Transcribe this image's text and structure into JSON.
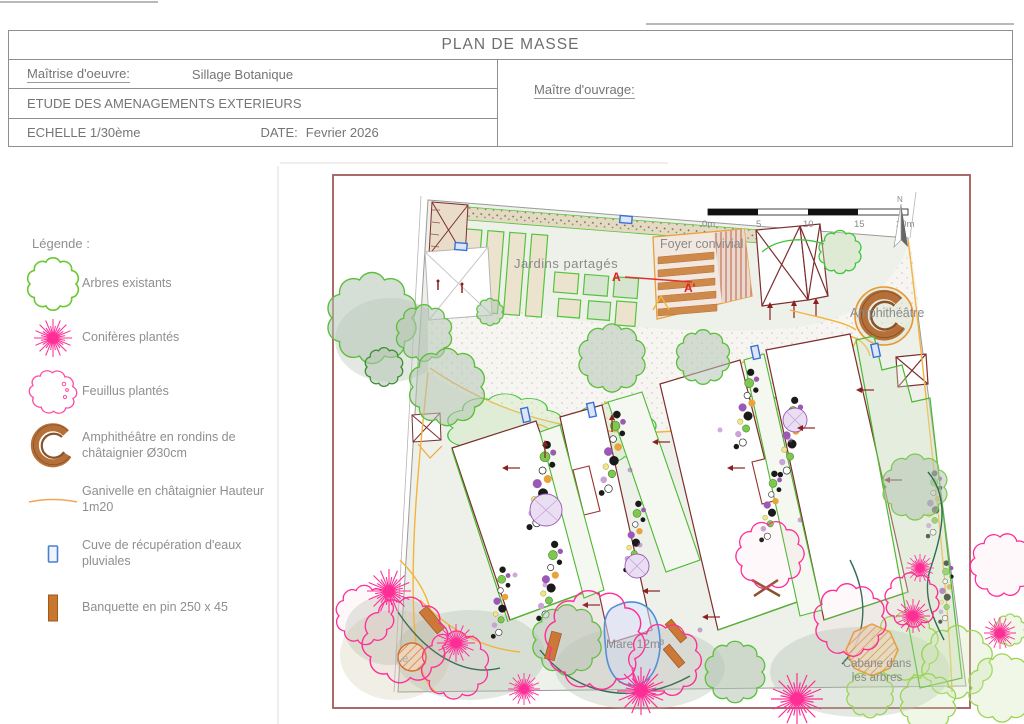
{
  "title_block": {
    "title": "PLAN DE MASSE",
    "moe_label": "Maîtrise d'oeuvre:",
    "moe_value": "Sillage Botanique",
    "study_title": "ETUDE DES AMENAGEMENTS EXTERIEURS",
    "scale": "ECHELLE 1/30ème",
    "date_label": "DATE:",
    "date_value": "Fevrier 2026",
    "moa_label": "Maître d'ouvrage:"
  },
  "legend": {
    "heading": "Légende :",
    "items": [
      {
        "symbol": "existing-tree",
        "label": "Arbres existants"
      },
      {
        "symbol": "planted-conifer",
        "label": "Conifères plantés"
      },
      {
        "symbol": "planted-deciduous",
        "label": "Feuillus plantés"
      },
      {
        "symbol": "amphitheater",
        "label": "Amphithéâtre en rondins de châtaignier Ø30cm"
      },
      {
        "symbol": "ganivelle-fence",
        "label": "Ganivelle en châtaignier Hauteur 1m20"
      },
      {
        "symbol": "rainwater-tank",
        "label": "Cuve de récupération d'eaux pluviales"
      },
      {
        "symbol": "pine-bench",
        "label": "Banquette en pin 250 x 45"
      }
    ]
  },
  "plan": {
    "labels": {
      "jardins_partages": "Jardins partagés",
      "foyer_convivial": "Foyer convivial",
      "amphitheatre": "Amphithéâtre",
      "mare": "Mare 12m³",
      "cabane_line1": "Cabane dans",
      "cabane_line2": "les arbres",
      "bottom_left": "Le",
      "section_start": "A",
      "section_end": "A'"
    },
    "north_label": "N",
    "scale_bar": {
      "tick0": "0m",
      "tick1": "5",
      "tick2": "10",
      "tick3": "15",
      "tick4": "20m"
    }
  },
  "colors": {
    "plan_border": "#a05a5a",
    "building_outline": "#7d2e2e",
    "existing_tree_green": "#5abf3a",
    "bright_green": "#4db830",
    "planted_pink": "#ff2d96",
    "ganivelle_orange": "#f0a640",
    "path_yellow": "#f2b43d",
    "water_blue": "#4a90d9",
    "wood_brown": "#c9762e",
    "label_grey": "#8a8a8a"
  }
}
